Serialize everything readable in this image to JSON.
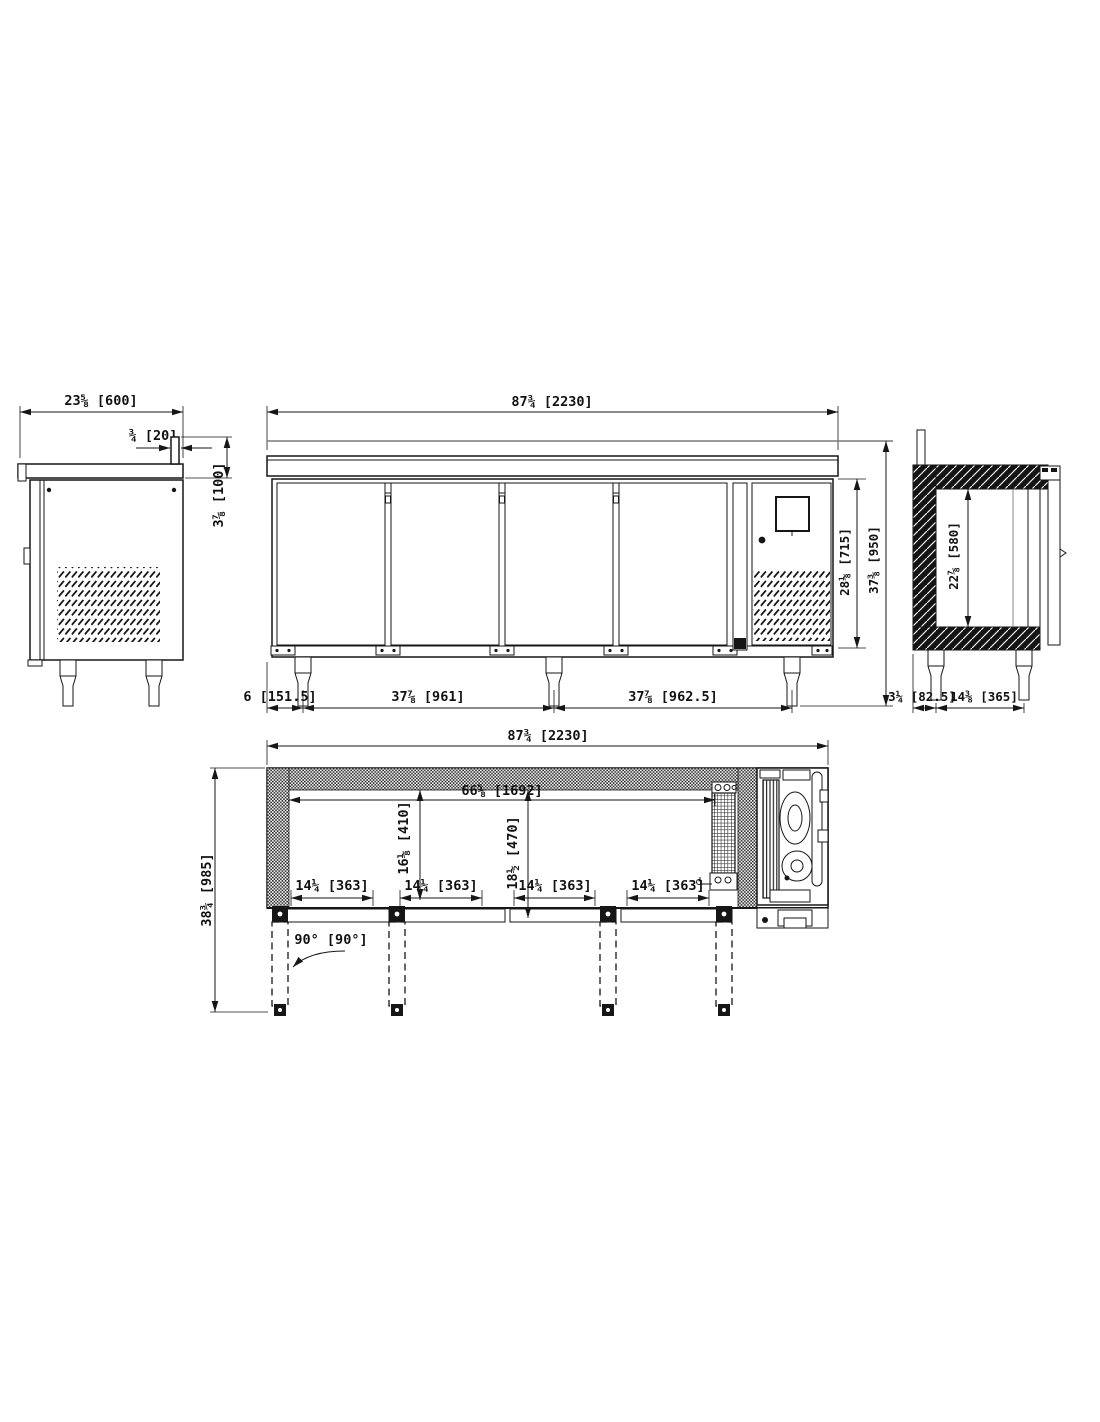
{
  "drawing": {
    "type": "technical-dimension-drawing",
    "subject": "4-door undercounter refrigerated counter, four orthographic views",
    "units": "inches [mm]",
    "line_color": "#161616",
    "background": "#ffffff",
    "views": {
      "side_left": {
        "title": "left side elevation",
        "dims": {
          "depth": "23⅝ [600]",
          "splash_lip": "¾ [20]",
          "splash_height": "3⅞ [100]"
        }
      },
      "front": {
        "title": "front elevation",
        "door_count": 4,
        "dims": {
          "width": "87¾ [2230]",
          "body_height": "28⅛ [715]",
          "overall_height": "37⅜ [950]",
          "leg_left": "6 [151.5]",
          "leg_mid": "37⅞ [961]",
          "leg_right": "37⅞ [962.5]"
        }
      },
      "side_right": {
        "title": "right side section",
        "dims": {
          "interior_height": "22⅞ [580]",
          "leg_offset": "3¼ [82.5]",
          "leg_spacing": "14⅜ [365]"
        }
      },
      "plan": {
        "title": "plan view with door swings",
        "dims": {
          "width": "87¾ [2230]",
          "depth_overall": "38¾ [985]",
          "interior_width": "66⅝ [1692]",
          "interior_depth": "16⅛ [410]",
          "door_depth": "18½ [470]",
          "door_widths": [
            "14¼ [363]",
            "14¼ [363]",
            "14¼ [363]",
            "14¼ [363]"
          ],
          "door_swing": "90° [90°]"
        }
      }
    }
  }
}
